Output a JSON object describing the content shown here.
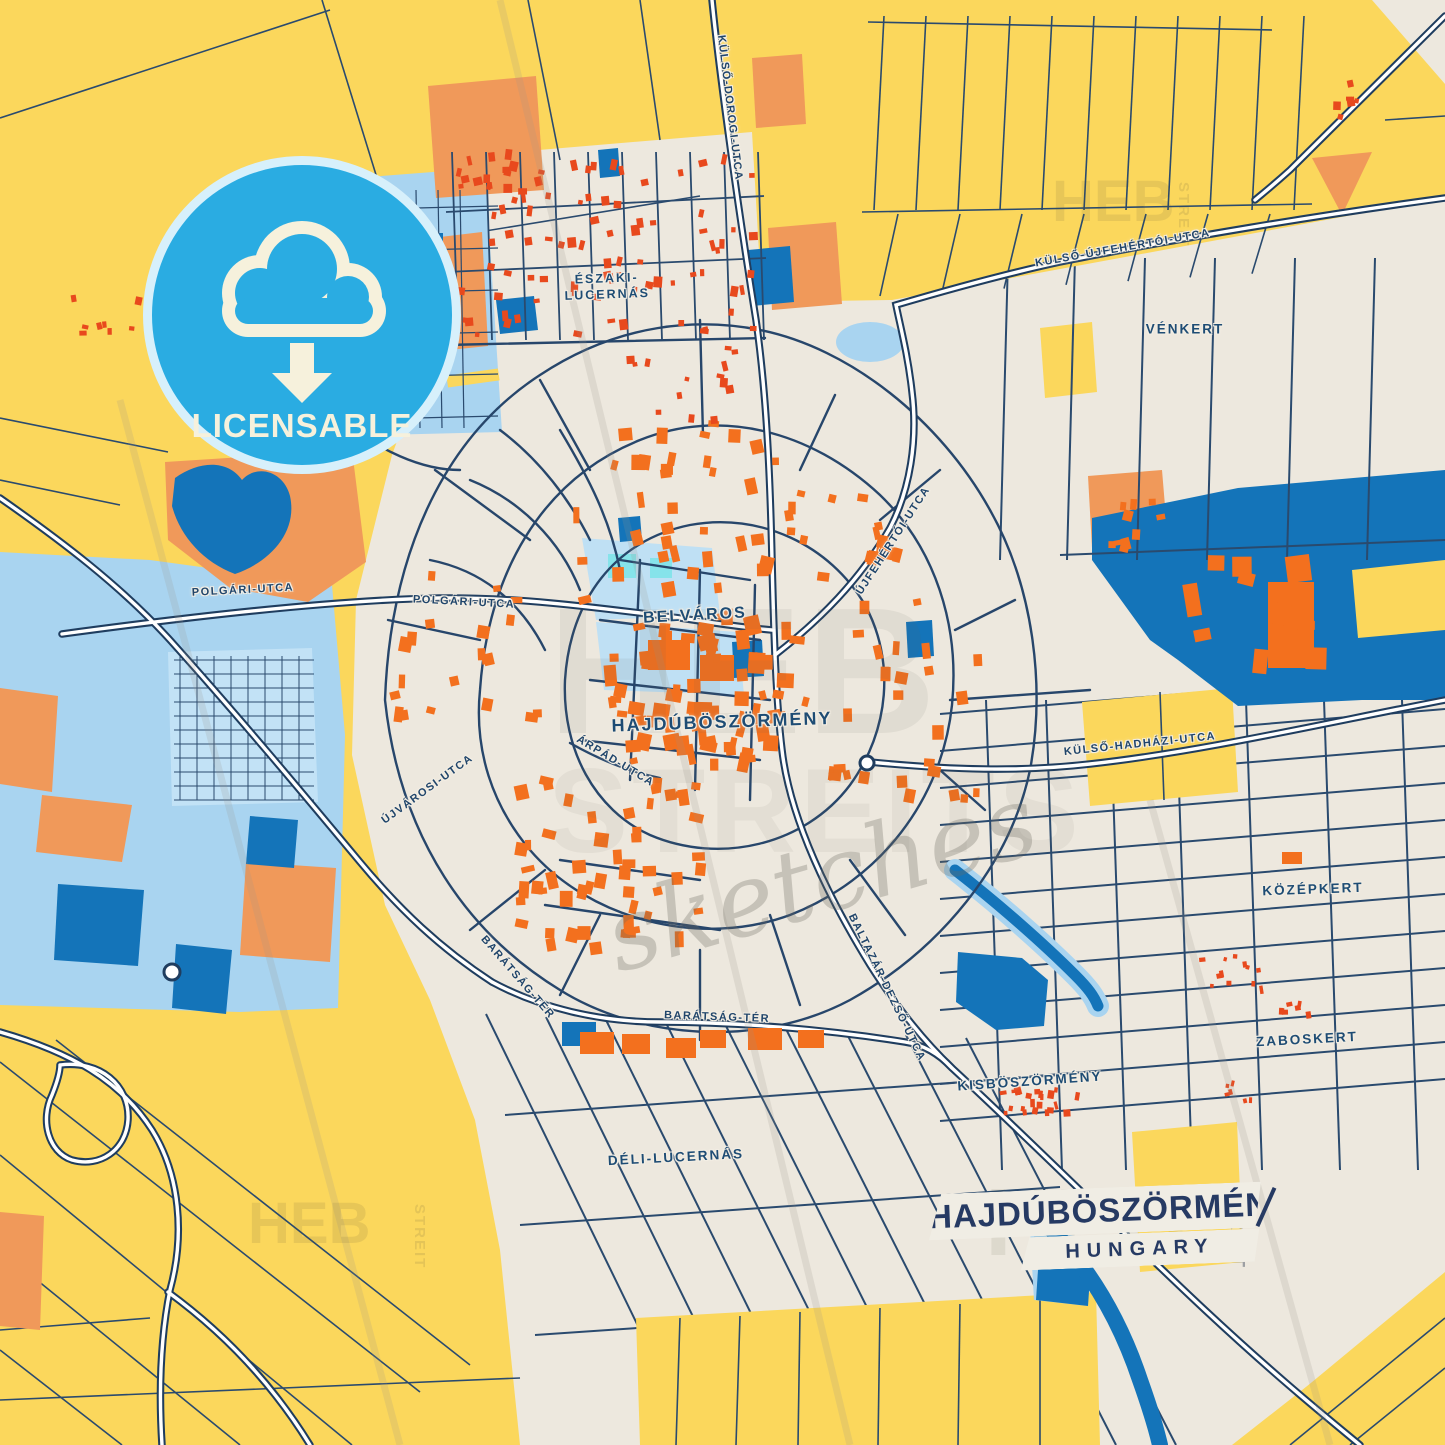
{
  "badge": {
    "label": "LICENSABLE"
  },
  "title": {
    "city": "HAJDÚBÖSZÖRMÉNY",
    "country": "HUNGARY"
  },
  "districts": [
    {
      "label": "ÉSZAKI-\nLUCERNÁS"
    },
    {
      "label": "VÉNKERT"
    },
    {
      "label": "BELVÁROS"
    },
    {
      "label": "HAJDÚBÖSZÖRMÉNY"
    },
    {
      "label": "KÖZÉPKERT"
    },
    {
      "label": "ZABOSKERT"
    },
    {
      "label": "KISBÖSZÖRMÉNY"
    },
    {
      "label": "DÉLI-LUCERNÁS"
    }
  ],
  "streets": [
    {
      "label": "KÜLSŐ-DOROGI-UTCA"
    },
    {
      "label": "KÜLSŐ-ÚJFEHÉRTÓI-UTCA"
    },
    {
      "label": "POLGÁRI-UTCA"
    },
    {
      "label": "ÚJFEHÉRTÓI-UTCA"
    },
    {
      "label": "KÜLSŐ-HADHÁZI-UTCA"
    },
    {
      "label": "ÚJVÁROSI-UTCA"
    },
    {
      "label": "ÁRPÁD-UTCA"
    },
    {
      "label": "BARÁTSÁG-TÉR"
    },
    {
      "label": "BALTAZÁR-DEZSŐ-UTCA"
    }
  ],
  "watermark": {
    "brand": "HEB",
    "brand_vertical": "STREIT",
    "brand_suffix": "STREITS",
    "script": "sketches"
  },
  "colors": {
    "field_yellow": "#FBD75C",
    "urban_cream": "#EDE8DE",
    "water_light": "#A9D4F0",
    "water_dark": "#1474B9",
    "area_orange": "#F0995A",
    "building_orange": "#F3701E",
    "building_red": "#E8491D",
    "road_navy": "#27466B",
    "badge_blue": "#2AACE2",
    "label_navy": "#1E4C74"
  }
}
